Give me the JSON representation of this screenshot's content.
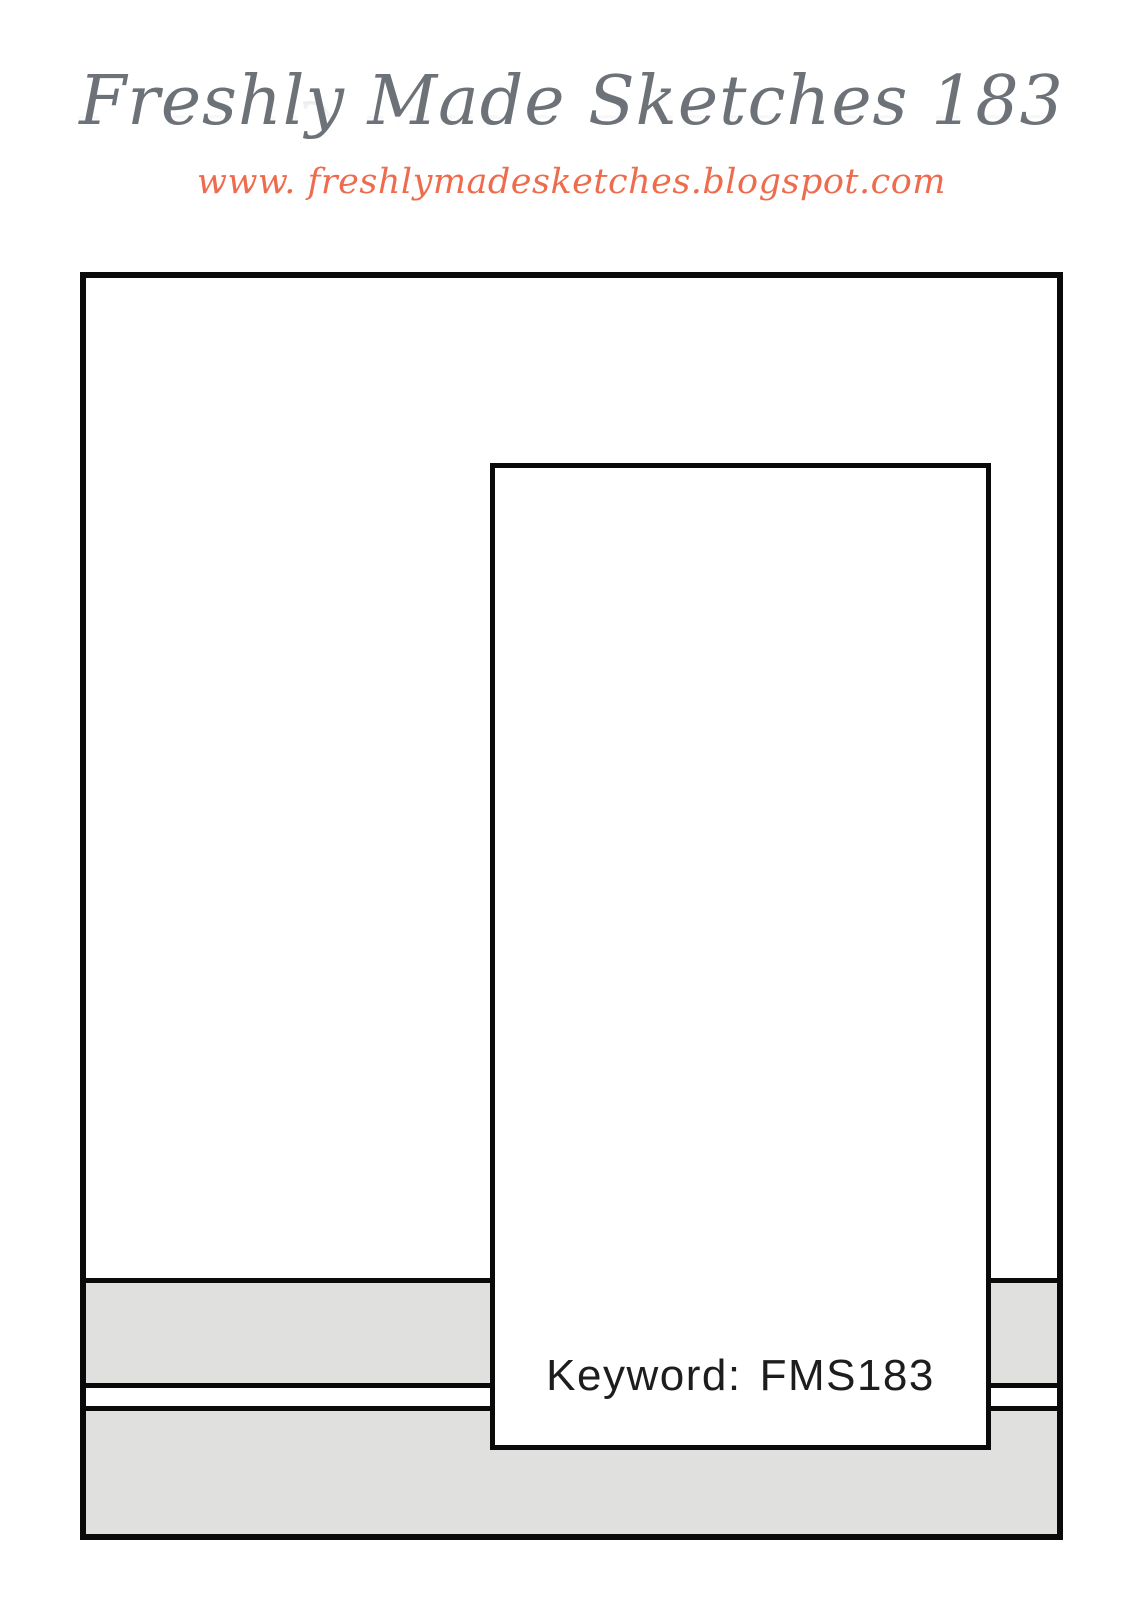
{
  "header": {
    "title": "Freshly Made Sketches 183",
    "url": "www. freshlymadesketches.blogspot.com"
  },
  "sketch": {
    "keyword_label": "Keyword:",
    "keyword_value": "FMS183"
  },
  "colors": {
    "title_gray": "#6C7277",
    "url_coral": "#EE6C4D",
    "strip_gray": "#E0E0DE",
    "outline_black": "#0A0A0A",
    "background": "#FFFFFF"
  }
}
